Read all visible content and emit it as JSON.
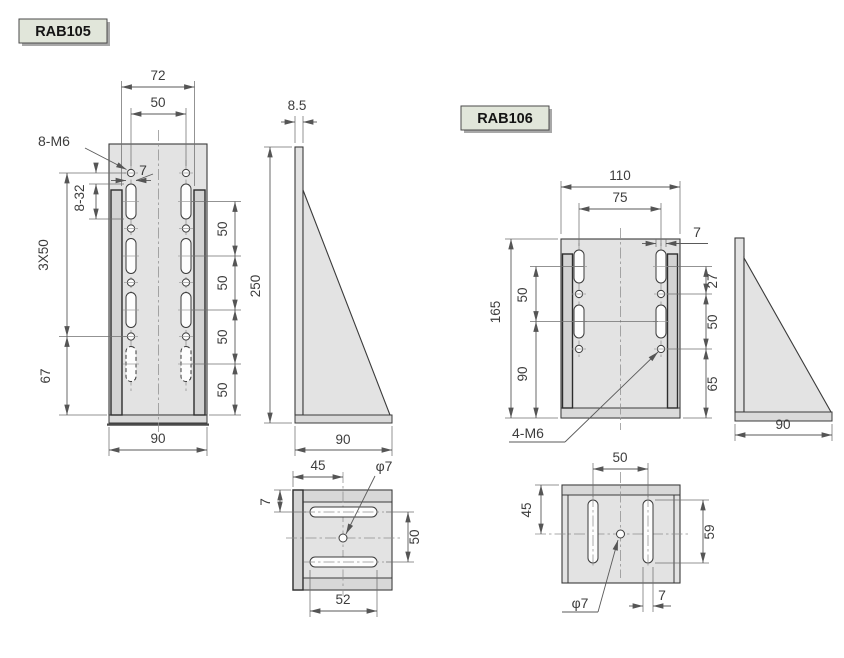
{
  "parts": {
    "rab105": {
      "label": "RAB105",
      "front": {
        "inner_width": "72",
        "hole_span": "50",
        "thread_callout": "8-M6",
        "slot_width": "7",
        "slot_dim": "8-32",
        "row_pitch": "3X50",
        "bottom_offset": "67",
        "base_width": "90",
        "pitch": "50"
      },
      "side": {
        "thickness": "8.5",
        "height": "250",
        "depth": "90"
      },
      "bottom": {
        "center_offset": "45",
        "hole_dia": "φ7",
        "edge_offset": "7",
        "slot_pitch": "50",
        "slot_length": "52"
      }
    },
    "rab106": {
      "label": "RAB106",
      "front": {
        "width": "110",
        "hole_span": "75",
        "slot_width": "7",
        "slot_hole_gap": "27",
        "hole_pitch": "50",
        "bottom_offset": "65",
        "height": "165",
        "upper_pitch": "50",
        "lower_span": "90",
        "thread_callout": "4-M6"
      },
      "side": {
        "depth": "90"
      },
      "bottom": {
        "slot_span": "50",
        "center_offset": "45",
        "slot_length": "59",
        "hole_dia": "φ7",
        "slot_width": "7"
      }
    }
  }
}
